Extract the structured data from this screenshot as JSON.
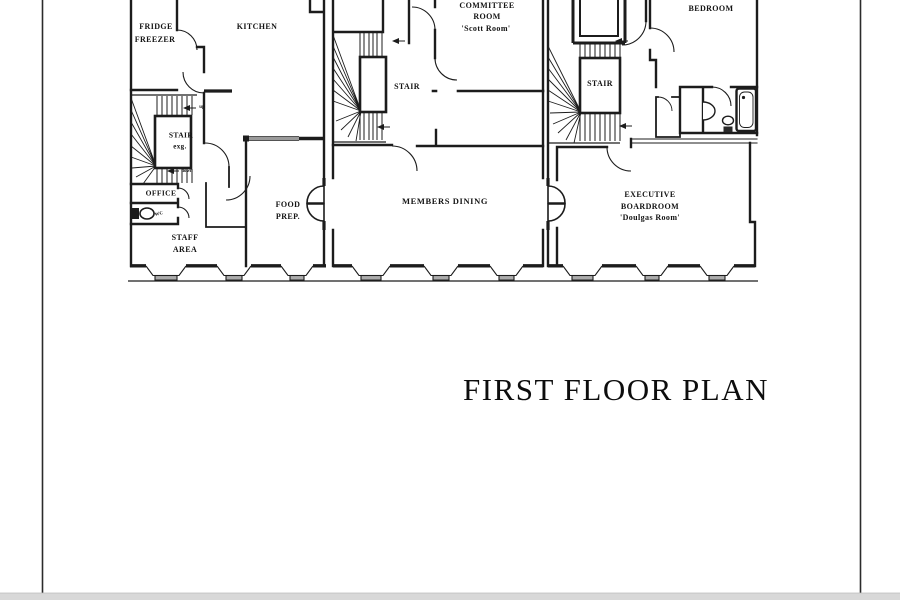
{
  "drawing": {
    "title": "FIRST FLOOR PLAN",
    "rooms": {
      "fridge_freezer": {
        "line1": "FRIDGE",
        "line2": "FREEZER"
      },
      "kitchen": {
        "label": "KITCHEN"
      },
      "stair_west": {
        "line1": "STAIR",
        "line2": "exg.",
        "up": "up",
        "down": "down"
      },
      "office": {
        "label": "OFFICE"
      },
      "wc": {
        "label": "WC"
      },
      "staff_area": {
        "line1": "STAFF",
        "line2": "AREA"
      },
      "food_prep": {
        "line1": "FOOD",
        "line2": "PREP."
      },
      "stair_mid": {
        "label": "STAIR"
      },
      "committee_room": {
        "line1": "COMMITTEE",
        "line2": "ROOM",
        "line3": "'Scott Room'"
      },
      "members_dining": {
        "label": "MEMBERS DINING"
      },
      "stair_east": {
        "label": "STAIR"
      },
      "bedroom": {
        "label": "BEDROOM"
      },
      "executive_boardroom": {
        "line1": "EXECUTIVE",
        "line2": "BOARDROOM",
        "line3": "'Doulgas Room'"
      }
    },
    "colors": {
      "ink": "#1c1c1c",
      "glazing": "#9a9a9a",
      "sill_fill": "#ababab",
      "footer_strip": "#d8d8d8"
    }
  }
}
